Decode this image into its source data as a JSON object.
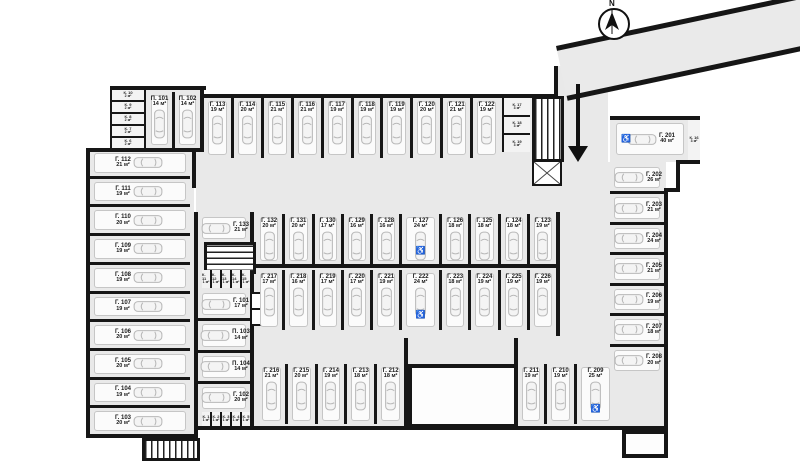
{
  "compass": {
    "label": "N"
  },
  "stall_groups": {
    "left_column": [
      {
        "id": "Г. 112",
        "area": "21 м²"
      },
      {
        "id": "Г. 111",
        "area": "19 м²"
      },
      {
        "id": "Г. 110",
        "area": "20 м²"
      },
      {
        "id": "Г. 109",
        "area": "19 м²"
      },
      {
        "id": "Г. 108",
        "area": "19 м²"
      },
      {
        "id": "Г. 107",
        "area": "19 м²"
      },
      {
        "id": "Г. 106",
        "area": "20 м²"
      },
      {
        "id": "Г. 105",
        "area": "20 м²"
      },
      {
        "id": "Г. 104",
        "area": "19 м²"
      },
      {
        "id": "Г. 103",
        "area": "20 м²"
      }
    ],
    "top_left": [
      {
        "id": "П. 101",
        "area": "14 м²"
      },
      {
        "id": "П. 102",
        "area": "14 м²"
      }
    ],
    "top_row": [
      {
        "id": "Г. 113",
        "area": "19 м²"
      },
      {
        "id": "Г. 114",
        "area": "20 м²"
      },
      {
        "id": "Г. 115",
        "area": "21 м²"
      },
      {
        "id": "Г. 116",
        "area": "21 м²"
      },
      {
        "id": "Г. 117",
        "area": "19 м²"
      },
      {
        "id": "Г. 118",
        "area": "19 м²"
      },
      {
        "id": "Г. 119",
        "area": "19 м²"
      },
      {
        "id": "Г. 120",
        "area": "20 м²"
      },
      {
        "id": "Г. 121",
        "area": "21 м²"
      },
      {
        "id": "Г. 122",
        "area": "19 м²"
      }
    ],
    "middle_left_top": [
      {
        "id": "Г. 133",
        "area": "21 м²"
      }
    ],
    "middle_upper_row": [
      {
        "id": "Г. 132",
        "area": "20 м²"
      },
      {
        "id": "Г. 131",
        "area": "20 м²"
      },
      {
        "id": "Г. 130",
        "area": "17 м²"
      },
      {
        "id": "Г. 129",
        "area": "16 м²"
      },
      {
        "id": "Г. 128",
        "area": "16 м²"
      },
      {
        "id": "Г. 127",
        "area": "24 м²",
        "accessible": true,
        "wide": true
      },
      {
        "id": "Г. 126",
        "area": "18 м²"
      },
      {
        "id": "Г. 125",
        "area": "18 м²"
      },
      {
        "id": "Г. 124",
        "area": "18 м²"
      },
      {
        "id": "Г. 123",
        "area": "19 м²"
      }
    ],
    "middle_lower_row": [
      {
        "id": "Г. 217",
        "area": "17 м²"
      },
      {
        "id": "Г. 218",
        "area": "16 м²"
      },
      {
        "id": "Г. 219",
        "area": "17 м²"
      },
      {
        "id": "Г. 220",
        "area": "17 м²"
      },
      {
        "id": "Г. 221",
        "area": "19 м²"
      },
      {
        "id": "Г. 222",
        "area": "24 м²",
        "accessible": true,
        "wide": true
      },
      {
        "id": "Г. 223",
        "area": "18 м²"
      },
      {
        "id": "Г. 224",
        "area": "19 м²"
      },
      {
        "id": "Г. 225",
        "area": "19 м²"
      },
      {
        "id": "Г. 226",
        "area": "19 м²"
      }
    ],
    "middle_left_column": [
      {
        "id": "Г. 101",
        "area": "17 м²"
      },
      {
        "id": "П. 103",
        "area": "14 м²"
      },
      {
        "id": "П. 104",
        "area": "14 м²"
      },
      {
        "id": "Г. 102",
        "area": "20 м²"
      }
    ],
    "right_wide": [
      {
        "id": "Г. 201",
        "area": "40 м²",
        "accessible": true
      }
    ],
    "right_column": [
      {
        "id": "Г. 202",
        "area": "26 м²"
      },
      {
        "id": "Г. 203",
        "area": "21 м²"
      },
      {
        "id": "Г. 204",
        "area": "24 м²"
      },
      {
        "id": "Г. 205",
        "area": "21 м²"
      },
      {
        "id": "Г. 206",
        "area": "19 м²"
      },
      {
        "id": "Г. 207",
        "area": "18 м²"
      },
      {
        "id": "Г. 208",
        "area": "20 м²"
      }
    ],
    "bottom_left_row": [
      {
        "id": "Г. 216",
        "area": "21 м²"
      },
      {
        "id": "Г. 215",
        "area": "20 м²"
      },
      {
        "id": "Г. 214",
        "area": "19 м²"
      },
      {
        "id": "Г. 213",
        "area": "18 м²"
      },
      {
        "id": "Г. 212",
        "area": "18 м²"
      }
    ],
    "bottom_right_row": [
      {
        "id": "Г. 211",
        "area": "19 м²"
      },
      {
        "id": "Г. 210",
        "area": "19 м²"
      },
      {
        "id": "Г. 209",
        "area": "25 м²",
        "accessible": true,
        "wide": true
      }
    ]
  },
  "cell_groups": {
    "top_left_cells": [
      {
        "id": "К. 10",
        "area": "2 м²"
      },
      {
        "id": "К. 9",
        "area": "2 м²"
      },
      {
        "id": "К. 8",
        "area": "2 м²"
      },
      {
        "id": "К. 7",
        "area": "2 м²"
      },
      {
        "id": "К. 6",
        "area": "2 м²"
      }
    ],
    "top_right_cells": [
      {
        "id": "К. 17",
        "area": "3 м²"
      },
      {
        "id": "К. 18",
        "area": "3 м²"
      },
      {
        "id": "К. 19",
        "area": "3 м²"
      }
    ],
    "middle_cells": [
      {
        "id": "К. 11",
        "area": "1 м²"
      },
      {
        "id": "К. 12",
        "area": "1 м²"
      },
      {
        "id": "К. 13",
        "area": "1 м²"
      },
      {
        "id": "К. 14",
        "area": "1 м²"
      },
      {
        "id": "К. 15",
        "area": "1 м²"
      }
    ],
    "bottom_cells": [
      {
        "id": "К. 1",
        "area": "1 м²"
      },
      {
        "id": "К. 2",
        "area": "1 м²"
      },
      {
        "id": "К. 3",
        "area": "1 м²"
      },
      {
        "id": "К. 4",
        "area": "1 м²"
      },
      {
        "id": "К. 5",
        "area": "1 м²"
      }
    ],
    "side_cell": [
      {
        "id": "К. 16",
        "area": "3 м²"
      }
    ]
  }
}
